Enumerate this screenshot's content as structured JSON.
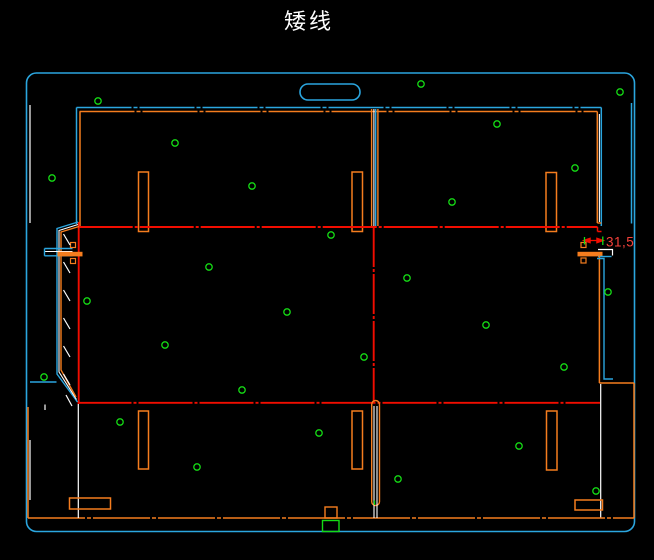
{
  "title": {
    "text": "矮线"
  },
  "dimension": {
    "label": "31,5"
  },
  "palette": {
    "cyan": "#2BA6DF",
    "orange": "#F57D1E",
    "red": "#F20D00",
    "redText": "#F5413A",
    "green": "#15DB15",
    "white": "#FFFFFF",
    "background": "#000000"
  },
  "canvas": {
    "w": 654,
    "h": 560
  },
  "dot_style": {
    "r": 3.2,
    "sw": 1.3,
    "color": "green"
  },
  "dots": [
    [
      98,
      101
    ],
    [
      421,
      84
    ],
    [
      620,
      92
    ],
    [
      497,
      124
    ],
    [
      175,
      143
    ],
    [
      575,
      168
    ],
    [
      52,
      178
    ],
    [
      252,
      186
    ],
    [
      452,
      202
    ],
    [
      331,
      235
    ],
    [
      209,
      267
    ],
    [
      407,
      278
    ],
    [
      287,
      312
    ],
    [
      608,
      292
    ],
    [
      87,
      301
    ],
    [
      486,
      325
    ],
    [
      165,
      345
    ],
    [
      364,
      357
    ],
    [
      564,
      367
    ],
    [
      44,
      377
    ],
    [
      242,
      390
    ],
    [
      120,
      422
    ],
    [
      197,
      467
    ],
    [
      319,
      433
    ],
    [
      398,
      479
    ],
    [
      519,
      446
    ],
    [
      596,
      491
    ]
  ],
  "entities": [
    {
      "kind": "rect",
      "name": "sheet-outline",
      "x": 26.5,
      "y": 73,
      "w": 608,
      "h": 458.5,
      "rx": 10,
      "color": "cyan",
      "sw": 1.6
    },
    {
      "kind": "line",
      "name": "sheet-inner-white-left-top",
      "x1": 30,
      "y1": 105,
      "x2": 30,
      "y2": 223,
      "color": "white",
      "sw": 1.2
    },
    {
      "kind": "line",
      "name": "sheet-inner-white-left-bottom",
      "x1": 30,
      "y1": 440,
      "x2": 30,
      "y2": 500,
      "color": "white",
      "sw": 1.2
    },
    {
      "kind": "line",
      "name": "right-wall-crease-top",
      "x1": 631.5,
      "y1": 103,
      "x2": 631.5,
      "y2": 223.5,
      "color": "cyan",
      "sw": 1.5
    },
    {
      "kind": "line",
      "name": "top-crease-cyan",
      "x1": 76.5,
      "y1": 107.5,
      "x2": 601.3,
      "y2": 107.5,
      "color": "cyan",
      "sw": 1.5,
      "dash": "55 2 4 2"
    },
    {
      "kind": "line",
      "name": "top-cut-orange",
      "x1": 79.5,
      "y1": 111.5,
      "x2": 597.3,
      "y2": 111.5,
      "color": "orange",
      "sw": 1.5,
      "dash": "55 2 4 2"
    },
    {
      "kind": "rect",
      "name": "handle-cutout",
      "x": 300,
      "y": 84,
      "w": 60,
      "h": 16,
      "rx": 8,
      "color": "cyan",
      "sw": 1.6
    },
    {
      "kind": "line",
      "name": "top-left-panel-left-cyan",
      "x1": 76.5,
      "y1": 107.5,
      "x2": 76.5,
      "y2": 224,
      "color": "cyan",
      "sw": 1.5
    },
    {
      "kind": "line",
      "name": "top-left-panel-left-orange",
      "x1": 80,
      "y1": 111.5,
      "x2": 80,
      "y2": 226,
      "color": "orange",
      "sw": 1.5
    },
    {
      "kind": "line",
      "name": "divider-orange-left",
      "x1": 371.6,
      "y1": 109,
      "x2": 371.6,
      "y2": 226,
      "color": "orange",
      "sw": 1.4
    },
    {
      "kind": "line",
      "name": "divider-white",
      "x1": 373.9,
      "y1": 109,
      "x2": 373.9,
      "y2": 226,
      "color": "white",
      "sw": 1.1
    },
    {
      "kind": "line",
      "name": "divider-cyan",
      "x1": 375.7,
      "y1": 109,
      "x2": 375.7,
      "y2": 226,
      "color": "cyan",
      "sw": 1.4
    },
    {
      "kind": "line",
      "name": "divider-orange-right",
      "x1": 377.9,
      "y1": 109,
      "x2": 377.9,
      "y2": 226,
      "color": "orange",
      "sw": 1.4
    },
    {
      "kind": "line",
      "name": "top-right-panel-right-orange",
      "x1": 597.3,
      "y1": 111.5,
      "x2": 597.3,
      "y2": 223,
      "color": "orange",
      "sw": 1.5
    },
    {
      "kind": "line",
      "name": "top-right-panel-right-white",
      "x1": 599.4,
      "y1": 114,
      "x2": 599.4,
      "y2": 222,
      "color": "white",
      "sw": 1.1
    },
    {
      "kind": "line",
      "name": "top-right-panel-right-cyan",
      "x1": 601.3,
      "y1": 107.5,
      "x2": 601.3,
      "y2": 226,
      "color": "cyan",
      "sw": 1.5
    },
    {
      "kind": "line",
      "name": "top-right-step-orange",
      "x1": 597.3,
      "y1": 223,
      "x2": 601.3,
      "y2": 223,
      "color": "orange",
      "sw": 1.4
    },
    {
      "kind": "rect",
      "name": "slot-top-left",
      "x": 138.5,
      "y": 172,
      "w": 10,
      "h": 59.5,
      "color": "orange",
      "sw": 1.5
    },
    {
      "kind": "rect",
      "name": "slot-top-mid",
      "x": 352,
      "y": 172,
      "w": 10.5,
      "h": 59.5,
      "color": "orange",
      "sw": 1.5
    },
    {
      "kind": "rect",
      "name": "slot-top-right",
      "x": 546,
      "y": 172.5,
      "w": 10.5,
      "h": 59,
      "color": "orange",
      "sw": 1.5
    },
    {
      "kind": "line",
      "name": "mid-crease-top",
      "x1": 78.7,
      "y1": 227,
      "x2": 597.5,
      "y2": 227,
      "color": "red",
      "sw": 1.9,
      "dash": "54 2 3 2"
    },
    {
      "kind": "line",
      "name": "mid-crease-top-step-v",
      "x1": 597.5,
      "y1": 227,
      "x2": 597.5,
      "y2": 231.5,
      "color": "red",
      "sw": 1.5
    },
    {
      "kind": "line",
      "name": "mid-crease-top-step-h",
      "x1": 597.5,
      "y1": 231.5,
      "x2": 601.5,
      "y2": 231.5,
      "color": "red",
      "sw": 1.5
    },
    {
      "kind": "line",
      "name": "mid-crease-bottom",
      "x1": 77.5,
      "y1": 402.8,
      "x2": 600,
      "y2": 402.8,
      "color": "red",
      "sw": 1.9,
      "dash": "54 2 3 2"
    },
    {
      "kind": "line",
      "name": "mid-crease-center",
      "x1": 373.7,
      "y1": 227,
      "x2": 373.7,
      "y2": 402.8,
      "color": "red",
      "sw": 1.9,
      "dash": "40 2 3 2"
    },
    {
      "kind": "line",
      "name": "mid-crease-left",
      "x1": 78.7,
      "y1": 222,
      "x2": 78.7,
      "y2": 404,
      "color": "red",
      "sw": 1.9
    },
    {
      "kind": "polyline",
      "name": "left-flap-cyan",
      "pts": "78,222 57,228.5 57,374 77.5,402",
      "color": "cyan",
      "sw": 1.4
    },
    {
      "kind": "polyline",
      "name": "left-flap-white",
      "pts": "78,224.5 59,230.5 59,372 76.5,399.5",
      "color": "white",
      "sw": 1.1
    },
    {
      "kind": "polyline",
      "name": "left-flap-orange",
      "pts": "79,226.5 61,232 61,370 76,397",
      "color": "orange",
      "sw": 1.4
    },
    {
      "kind": "line",
      "name": "left-tab-cyan-top",
      "x1": 44.5,
      "y1": 248.5,
      "x2": 72.5,
      "y2": 248.5,
      "color": "cyan",
      "sw": 1.4
    },
    {
      "kind": "line",
      "name": "left-tab-white",
      "x1": 44.5,
      "y1": 251.5,
      "x2": 72.5,
      "y2": 251.5,
      "color": "white",
      "sw": 1.1
    },
    {
      "kind": "line",
      "name": "left-tab-cyan-bottom",
      "x1": 44.5,
      "y1": 255.8,
      "x2": 72.5,
      "y2": 255.8,
      "color": "cyan",
      "sw": 1.4
    },
    {
      "kind": "line",
      "name": "left-tab-cyan-end",
      "x1": 44.5,
      "y1": 248.5,
      "x2": 44.5,
      "y2": 255.8,
      "color": "cyan",
      "sw": 1.4
    },
    {
      "kind": "rect",
      "name": "left-glue-bar",
      "x": 58,
      "y": 252.3,
      "w": 24,
      "h": 3.6,
      "color": "orange",
      "fill": "orange",
      "sw": 1
    },
    {
      "kind": "rect",
      "name": "left-mark-upper",
      "x": 70.5,
      "y": 242.5,
      "w": 5,
      "h": 5,
      "color": "orange",
      "sw": 1.2
    },
    {
      "kind": "rect",
      "name": "left-mark-lower",
      "x": 70.5,
      "y": 258.5,
      "w": 5,
      "h": 5,
      "color": "orange",
      "sw": 1.2
    },
    {
      "kind": "line",
      "name": "tear-dash-1",
      "x1": 63.5,
      "y1": 234,
      "x2": 70,
      "y2": 245,
      "color": "white",
      "sw": 1.2
    },
    {
      "kind": "line",
      "name": "tear-dash-2",
      "x1": 63.5,
      "y1": 262,
      "x2": 70,
      "y2": 273,
      "color": "white",
      "sw": 1.2
    },
    {
      "kind": "line",
      "name": "tear-dash-3",
      "x1": 63.5,
      "y1": 290,
      "x2": 70,
      "y2": 301,
      "color": "white",
      "sw": 1.2
    },
    {
      "kind": "line",
      "name": "tear-dash-4",
      "x1": 63.5,
      "y1": 318,
      "x2": 70,
      "y2": 329,
      "color": "white",
      "sw": 1.2
    },
    {
      "kind": "line",
      "name": "tear-dash-5",
      "x1": 63.5,
      "y1": 346,
      "x2": 70,
      "y2": 357,
      "color": "white",
      "sw": 1.2
    },
    {
      "kind": "line",
      "name": "tear-dash-6",
      "x1": 63.5,
      "y1": 374,
      "x2": 70,
      "y2": 385,
      "color": "white",
      "sw": 1.2
    },
    {
      "kind": "line",
      "name": "tear-dash-7",
      "x1": 66,
      "y1": 395,
      "x2": 72,
      "y2": 406,
      "color": "white",
      "sw": 1.2
    },
    {
      "kind": "line",
      "name": "left-bottom-tab-cyan",
      "x1": 30,
      "y1": 382,
      "x2": 56.5,
      "y2": 382,
      "color": "cyan",
      "sw": 1.4
    },
    {
      "kind": "rect",
      "name": "right-glue-bar",
      "x": 578,
      "y": 252.3,
      "w": 24,
      "h": 3.6,
      "color": "orange",
      "fill": "orange",
      "sw": 1
    },
    {
      "kind": "rect",
      "name": "right-mark-upper",
      "x": 581,
      "y": 242.5,
      "w": 5,
      "h": 5,
      "color": "orange",
      "sw": 1.2
    },
    {
      "kind": "rect",
      "name": "right-mark-lower",
      "x": 581,
      "y": 258,
      "w": 5,
      "h": 5,
      "color": "orange",
      "sw": 1.2
    },
    {
      "kind": "polyline",
      "name": "right-notch-white",
      "pts": "598,249.5 612.5,249.5 612.5,255.5",
      "color": "white",
      "sw": 1.2
    },
    {
      "kind": "line",
      "name": "right-notch-cyan",
      "x1": 598,
      "y1": 256.5,
      "x2": 611.5,
      "y2": 256.5,
      "color": "cyan",
      "sw": 1.4
    },
    {
      "kind": "line",
      "name": "right-cut-orange",
      "x1": 599.4,
      "y1": 256,
      "x2": 599.4,
      "y2": 383,
      "color": "orange",
      "sw": 1.5
    },
    {
      "kind": "polyline",
      "name": "right-crease-cyan",
      "pts": "597,258.5 604,258.5 604,379 613,379",
      "color": "cyan",
      "sw": 1.4
    },
    {
      "kind": "line",
      "name": "right-flap-top-orange",
      "x1": 599.4,
      "y1": 383,
      "x2": 634,
      "y2": 383,
      "color": "orange",
      "sw": 1.5
    },
    {
      "kind": "line",
      "name": "right-flap-right-orange",
      "x1": 634,
      "y1": 383,
      "x2": 634,
      "y2": 518,
      "color": "orange",
      "sw": 1.5
    },
    {
      "kind": "line",
      "name": "right-white-vert",
      "x1": 600.7,
      "y1": 384,
      "x2": 600.7,
      "y2": 518,
      "color": "white",
      "sw": 1.2
    },
    {
      "kind": "line",
      "name": "bottom-cut-orange",
      "x1": 28,
      "y1": 518,
      "x2": 634,
      "y2": 518,
      "color": "orange",
      "sw": 1.6,
      "dash": "57 2 4 2"
    },
    {
      "kind": "line",
      "name": "bottom-left-orange",
      "x1": 28,
      "y1": 407,
      "x2": 28,
      "y2": 518,
      "color": "orange",
      "sw": 1.5
    },
    {
      "kind": "line",
      "name": "bottom-left-white",
      "x1": 78.3,
      "y1": 404,
      "x2": 78.3,
      "y2": 518,
      "color": "white",
      "sw": 1.2
    },
    {
      "kind": "line",
      "name": "bottom-left-tick-white",
      "x1": 45,
      "y1": 404.5,
      "x2": 45,
      "y2": 410,
      "color": "white",
      "sw": 1.2
    },
    {
      "kind": "rect",
      "name": "center-slot",
      "x": 371.7,
      "y": 400.5,
      "w": 7.8,
      "h": 105,
      "rx": 3.9,
      "color": "orange",
      "sw": 1.4
    },
    {
      "kind": "line",
      "name": "center-slot-white-left",
      "x1": 374,
      "y1": 406,
      "x2": 374,
      "y2": 518,
      "color": "white",
      "sw": 1.1
    },
    {
      "kind": "line",
      "name": "center-slot-white-right",
      "x1": 377,
      "y1": 406,
      "x2": 377,
      "y2": 518,
      "color": "white",
      "sw": 1.1
    },
    {
      "kind": "line",
      "name": "center-slot-green-tick",
      "x1": 374.5,
      "y1": 500.5,
      "x2": 374.5,
      "y2": 505,
      "color": "green",
      "sw": 1.4
    },
    {
      "kind": "rect",
      "name": "slot-bottom-left",
      "x": 138.5,
      "y": 411,
      "w": 10,
      "h": 58,
      "color": "orange",
      "sw": 1.5
    },
    {
      "kind": "rect",
      "name": "slot-bottom-mid",
      "x": 352,
      "y": 411,
      "w": 10.5,
      "h": 58,
      "color": "orange",
      "sw": 1.5
    },
    {
      "kind": "rect",
      "name": "slot-bottom-right",
      "x": 546.5,
      "y": 411,
      "w": 10.5,
      "h": 59,
      "color": "orange",
      "sw": 1.5
    },
    {
      "kind": "rect",
      "name": "hslot-bottom-left",
      "x": 69.5,
      "y": 498,
      "w": 41,
      "h": 11,
      "color": "orange",
      "sw": 1.5
    },
    {
      "kind": "rect",
      "name": "hslot-bottom-right",
      "x": 575,
      "y": 500,
      "w": 27.5,
      "h": 10,
      "color": "orange",
      "sw": 1.5
    },
    {
      "kind": "rect",
      "name": "bottom-tab-orange",
      "x": 325,
      "y": 507,
      "w": 12,
      "h": 11,
      "color": "orange",
      "sw": 1.4
    },
    {
      "kind": "rect",
      "name": "bottom-tab-green",
      "x": 322.5,
      "y": 520.5,
      "w": 16.5,
      "h": 11,
      "color": "green",
      "sw": 1.4
    },
    {
      "kind": "line",
      "name": "dim-line",
      "x1": 586,
      "y1": 240.5,
      "x2": 601,
      "y2": 240.5,
      "color": "red",
      "sw": 1.3
    },
    {
      "kind": "polygon",
      "name": "dim-arrow-left",
      "pts": "584,240.5 590,238.4 590,242.6",
      "color": "red",
      "fill": "red"
    },
    {
      "kind": "polygon",
      "name": "dim-arrow-right",
      "pts": "603,240.5 597,238.4 597,242.6",
      "color": "red",
      "fill": "red"
    },
    {
      "kind": "line",
      "name": "dim-ext-left",
      "x1": 584.5,
      "y1": 237,
      "x2": 584.5,
      "y2": 244.5,
      "color": "green",
      "sw": 1.3
    },
    {
      "kind": "line",
      "name": "dim-ext-right",
      "x1": 602.8,
      "y1": 236.5,
      "x2": 602.8,
      "y2": 245,
      "color": "green",
      "sw": 1.3
    },
    {
      "kind": "text",
      "name": "dim-label",
      "x": 606,
      "y": 246.5,
      "size": 13.5,
      "ls": 0.5,
      "anchor": "start",
      "color": "redText",
      "bind": "dimension.label"
    },
    {
      "kind": "text",
      "name": "title-text",
      "x": 309,
      "y": 29,
      "size": 22,
      "ls": 3,
      "anchor": "middle",
      "color": "white",
      "bind": "title.text"
    }
  ]
}
